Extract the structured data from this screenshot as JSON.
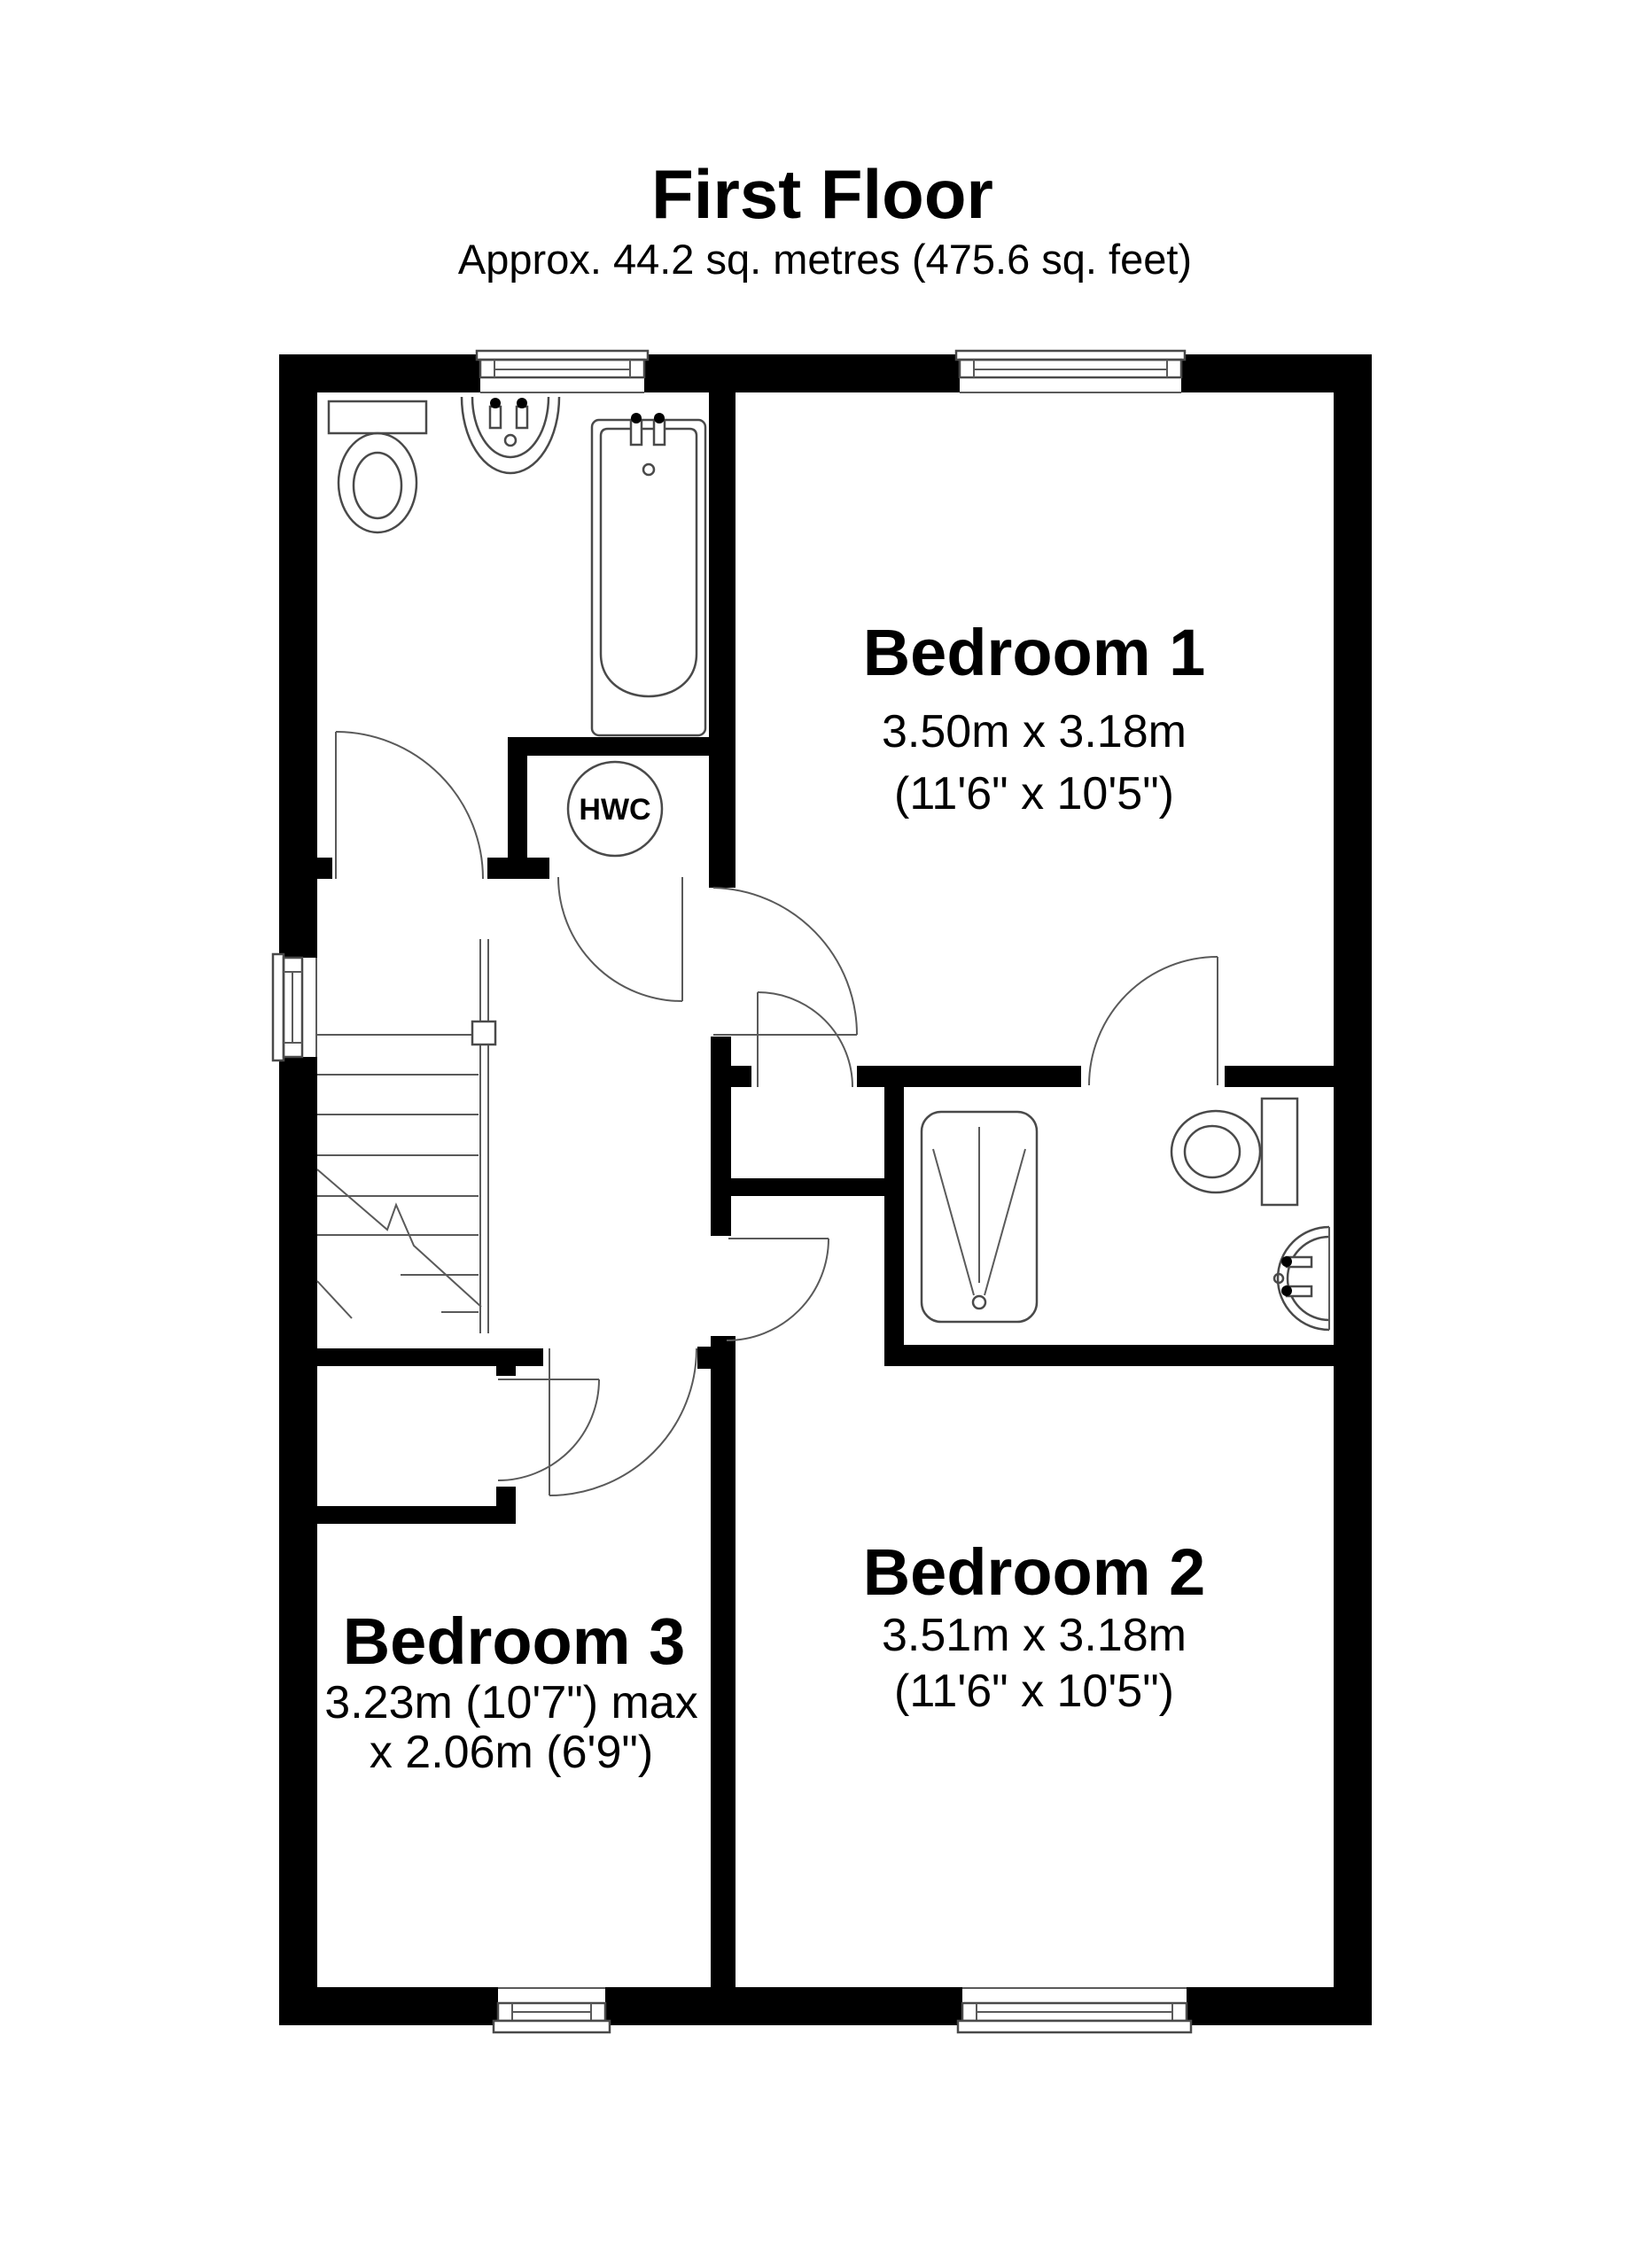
{
  "title": "First Floor",
  "subtitle": "Approx. 44.2 sq. metres (475.6 sq. feet)",
  "rooms": {
    "bedroom1": {
      "name": "Bedroom 1",
      "metric": "3.50m x 3.18m",
      "imperial": "(11'6\" x 10'5\")"
    },
    "bedroom2": {
      "name": "Bedroom 2",
      "metric": "3.51m x 3.18m",
      "imperial": "(11'6\" x 10'5\")"
    },
    "bedroom3": {
      "name": "Bedroom 3",
      "metric": "3.23m (10'7\") max",
      "imperial": "x 2.06m (6'9\")"
    },
    "hwc": {
      "label": "HWC"
    }
  },
  "fixtures": {
    "bathroom": [
      "toilet",
      "sink",
      "bathtub"
    ],
    "ensuite": [
      "shower",
      "toilet",
      "sink"
    ],
    "other": [
      "stairs",
      "hot-water-cylinder"
    ]
  },
  "colors": {
    "wall": "#000000",
    "line": "#4a4a4a",
    "background": "#ffffff"
  }
}
